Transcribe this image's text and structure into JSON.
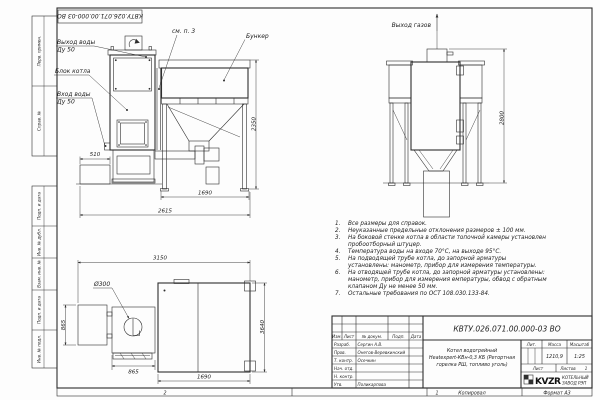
{
  "sheet": {
    "doc_number": "КВТУ.026.071.00.000-03 ВО",
    "strip": {
      "zone2": "2",
      "zone1": "1",
      "copied": "Копировал",
      "format": "Формат А3"
    }
  },
  "frame": {
    "side_labels": [
      "Перв. примен.",
      "Справ. №",
      "Подп. и дата",
      "Инв. № дубл.",
      "Взам. инв. №",
      "Подп. и дата",
      "Инв. № подл."
    ]
  },
  "views": {
    "front": {
      "water_out": [
        "Выход воды",
        "Ду 50"
      ],
      "boiler": "Блок котла",
      "water_in": [
        "Вход воды",
        "Ду 50"
      ],
      "see_note": "см. п. 3",
      "bunker": "Бункер",
      "dims": {
        "foundation": "510",
        "bunker_h": "2350",
        "bunker_w": "1690",
        "total_w": "2615"
      }
    },
    "side": {
      "gas_out": "Выход газов",
      "dims": {
        "total_h": "2800"
      }
    },
    "plan": {
      "hole": "Ø300",
      "dims": {
        "total_w": "3150",
        "left_d": "865",
        "firebox_w": "865",
        "bunker_w": "1690",
        "total_d": "3640"
      }
    }
  },
  "notes": {
    "items": [
      {
        "num": "1.",
        "text": "Все размеры для справок."
      },
      {
        "num": "2.",
        "text": "Неуказанные предельные отклонения размеров ± 100 мм."
      },
      {
        "num": "3.",
        "text": "На боковой стенке котла в области топочной камеры установлен пробоотборный штуцер."
      },
      {
        "num": "4.",
        "text": "Температура воды на входе 70°С, на выходе 95°С."
      },
      {
        "num": "5.",
        "text": "На подводящей трубе котла, до запорной арматуры установлены: манометр, прибор для измерения температуры."
      },
      {
        "num": "6.",
        "text": "На отводящей трубе котла, до запорной арматуры установлены: манометр, прибор для измерения емпературы, обвод с обратным клапаном Ду не менее 50 мм."
      },
      {
        "num": "7.",
        "text": "Остальные требования по ОСТ 108.030.133-84."
      }
    ]
  },
  "title_block": {
    "doc_number": "КВТУ.026.071.00.000-03 ВО",
    "product": [
      "Котел водогрейный",
      "Heatexpert-КВн-0,3 КБ (Ретортная",
      "горелка РШ, топливо уголь)"
    ],
    "cols": {
      "izm": "Изм.",
      "list": "Лист",
      "doc": "№ докум.",
      "podp": "Подп.",
      "date": "Дата"
    },
    "props": {
      "lit": "Лит.",
      "mass": "Масса",
      "scale": "Масштаб",
      "mass_value": "1210,9",
      "scale_value": "1:25",
      "sheet": "Лист",
      "sheets": "Листов",
      "sheets_value": "1"
    },
    "people": [
      {
        "role": "Разраб.",
        "name": "Сергин А.В."
      },
      {
        "role": "Пров.",
        "name": "Онегов-Веревкинский"
      },
      {
        "role": "Т. контр.",
        "name": "Осечкин"
      },
      {
        "role": "Нач. отд.",
        "name": ""
      },
      {
        "role": "Н. контр.",
        "name": ""
      },
      {
        "role": "Утв.",
        "name": "Поликарпова"
      }
    ],
    "logo": "KVZR",
    "company": [
      "КОТЕЛЬНЫЙ",
      "ЗАВОД РЭП"
    ]
  }
}
